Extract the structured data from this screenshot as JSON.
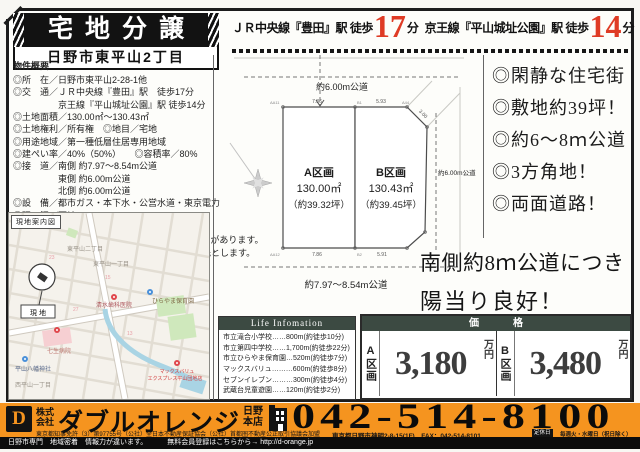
{
  "colors": {
    "accent_orange": "#f5941f",
    "table_header_green": "#3c4a42",
    "highlight_red": "#df3b25",
    "strip_black": "#0c0c0c"
  },
  "header": {
    "title": "宅地分譲",
    "location": "日野市東平山2丁目",
    "access": [
      {
        "line": "ＪＲ中央線『豊田』駅 徒歩",
        "minutes": "17",
        "unit": "分"
      },
      {
        "line": "京王線『平山城址公園』駅 徒歩",
        "minutes": "14",
        "unit": "分"
      }
    ]
  },
  "overview": {
    "heading": "物件概要",
    "rows": [
      "◎所　在／日野市東平山2-28-1他",
      "◎交　通／ＪＲ中央線『豊田』駅　徒歩17分",
      "京王線『平山城址公園』駅 徒歩14分",
      "◎土地面積／130.00㎡〜130.43㎡",
      "◎土地権利／所有権　◎地目／宅地",
      "◎用途地域／第一種低層住居専用地域",
      "◎建ぺい率／40%（50%）　　◎容積率／80%",
      "◎接　道／南側 約7.97〜8.54m公道",
      "東側 約6.00m公道",
      "北側 約6.00m公道",
      "◎設　備／都市ガス・本下水・公営水道・東京電力",
      "◎現　況／更地",
      "◎備　考／宅地分譲　平山遺跡",
      "分筆前につき、面積が増減する可能性があります。",
      "図面と現況が相違する場合は現況優先とします。"
    ]
  },
  "site_plan": {
    "road_north": "約6.00m公道",
    "road_east": "約6.00m公道",
    "road_south": "約7.97〜8.54m公道",
    "lot_a": {
      "name": "A区画",
      "area": "130.00㎡",
      "tsubo": "（約39.32坪）"
    },
    "lot_b": {
      "name": "B区画",
      "area": "130.43㎡",
      "tsubo": "（約39.45坪）"
    },
    "dims": {
      "top_a": "7.86",
      "top_b": "5.93",
      "diag": "3.00",
      "bottom_a": "7.86",
      "bottom_b": "5.91"
    },
    "points": {
      "p1": "AA11",
      "p2": "B1",
      "p3": "A44",
      "p4": "AA12",
      "p5": "B2"
    }
  },
  "highlights": [
    "◎閑静な住宅街",
    "◎敷地約39坪！",
    "◎約6〜8ｍ公道",
    "◎3方角地！",
    "◎両面道路！"
  ],
  "catchcopy": {
    "line1": "南側約8ｍ公道につき",
    "line2": "陽当り良好！"
  },
  "map": {
    "title": "現地案内図",
    "site_label": "現 地",
    "poi": {
      "area2": "東平山二丁目",
      "area1": "東平山一丁目",
      "dental": "清水歯科医院",
      "nursery": "ひらやま保育園",
      "shrine": "平山八幡神社",
      "hospital": "七生病院",
      "store1": "マックスバリュ",
      "store2": "エクスプレス平山団地店",
      "west": "西平山一丁目"
    },
    "house_numbers": [
      "23",
      "15",
      "27",
      "13"
    ]
  },
  "life_info": {
    "header": "Life Infomation",
    "items": [
      "市立滝合小学校……800m(約徒歩10分)",
      "市立第四中学校……1,700m(約徒歩22分)",
      "市立ひらやま保育園…520m(約徒歩7分)",
      "マックスバリュ………600m(約徒歩8分)",
      "セブンイレブン………300m(約徒歩4分)",
      "武蔵台児童遊園……120m(約徒歩2分)"
    ]
  },
  "price": {
    "header": "価　格",
    "lots": [
      {
        "label": "A区画",
        "amount": "3,180",
        "unit": "万円"
      },
      {
        "label": "B区画",
        "amount": "3,480",
        "unit": "万円"
      }
    ]
  },
  "footer": {
    "logo_letter": "D",
    "company_top": "株式",
    "company_bottom": "会社",
    "company_name": "ダブルオレンジ",
    "branch_top": "日野",
    "branch_bottom": "本店",
    "phone": "042-514-8100",
    "license": "東京都知事免許（3）第97755号（公社）全日本不動産保証協会（公社）首都圏不動産公正取引協議会加盟",
    "address": "東京都日野市神明2-8-15(1F)　FAX：042-514-8101",
    "holiday_label": "定休日",
    "holiday": "毎週火・水曜日（祝日除く）"
  },
  "strip": {
    "left": "日野市専門　地域密着　情報力が違います。",
    "right": "無料会員登録はこちらから→ http://d-orange.jp"
  }
}
